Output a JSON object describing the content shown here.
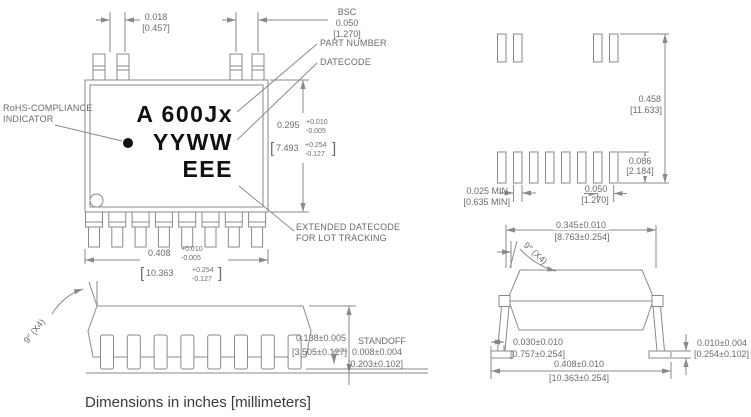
{
  "caption": "Dimensions in inches [millimeters]",
  "glyphs": {
    "lb": "[",
    "rb": "]"
  },
  "top_view": {
    "marking_line1": "A  600Jx",
    "marking_line2": "YYWW",
    "marking_line3": "EEE",
    "rohs_label_1": "RoHS-COMPLIANCE",
    "rohs_label_2": "INDICATOR",
    "part_number_label": "PART NUMBER",
    "datecode_label": "DATECODE",
    "ext_datecode_1": "EXTENDED DATECODE",
    "ext_datecode_2": "FOR LOT TRACKING",
    "lead_width_in": "0.018",
    "lead_width_mm": "[0.457]",
    "pitch_bsc": "BSC",
    "pitch_in": "0.050",
    "pitch_mm": "[1.270]",
    "body_depth_in": "0.295",
    "body_depth_tp": "+0.010",
    "body_depth_tm": "-0.005",
    "body_depth_mm": "7.493",
    "body_depth_mm_tp": "+0.254",
    "body_depth_mm_tm": "-0.127",
    "body_width_in": "0.408",
    "body_width_tp": "+0.010",
    "body_width_tm": "-0.005",
    "body_width_mm": "10.363",
    "body_width_mm_tp": "+0.254",
    "body_width_mm_tm": "-0.127"
  },
  "side_view": {
    "angle": "9° (X4)",
    "height_in": "0.138±0.005",
    "height_mm": "[3.505±0.127]",
    "standoff_label": "STANDOFF",
    "standoff_in": "0.008±0.004",
    "standoff_mm": "[0.203±0.102]"
  },
  "land_pattern": {
    "span_in": "0.458",
    "span_mm": "[11.633]",
    "pad_length_in": "0.086",
    "pad_length_mm": "[2.184]",
    "pad_width_in": "0.025 MIN",
    "pad_width_mm": "[0.635 MIN]",
    "pitch_in": "0.050",
    "pitch_mm": "[1.270]"
  },
  "end_view": {
    "angle": "9° (X4)",
    "body_width_in": "0.345±0.010",
    "body_width_mm": "[8.763±0.254]",
    "foot_length_in": "0.030±0.010",
    "foot_length_mm": "[0.757±0.254]",
    "overall_width_in": "0.408±0.010",
    "overall_width_mm": "[10.363±0.254]",
    "lead_thickness_in": "0.010±0.004",
    "lead_thickness_mm": "[0.254±0.102]"
  }
}
